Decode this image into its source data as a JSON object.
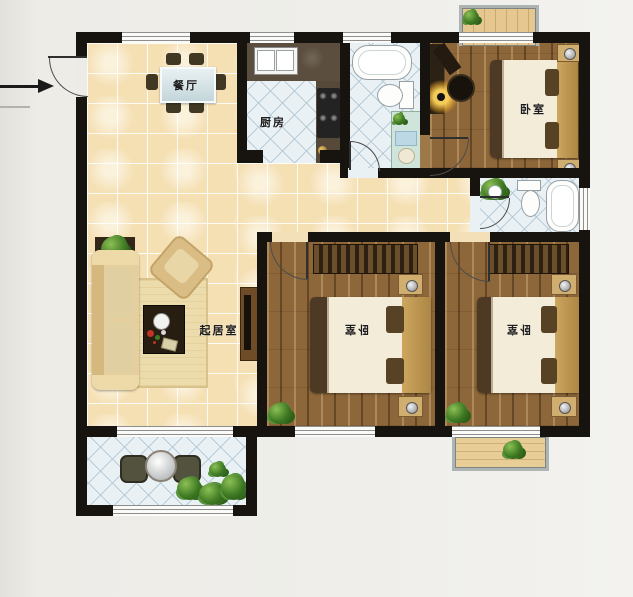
{
  "rooms": {
    "dining": {
      "label": "餐厅"
    },
    "kitchen": {
      "label": "厨房"
    },
    "living": {
      "label": "起居室"
    },
    "bedroom_top": {
      "label": "卧室"
    },
    "bedroom_mid": {
      "label": "卧室"
    },
    "bedroom_right": {
      "label": "卧室"
    }
  },
  "colors": {
    "wall": "#17130e",
    "beige_tile": "#f5e0b4",
    "blue_tile": "#e9f1f5",
    "bedroom_wood": "#8d6739",
    "balcony_wood": "#e5c78f",
    "background": "#efeeea"
  }
}
